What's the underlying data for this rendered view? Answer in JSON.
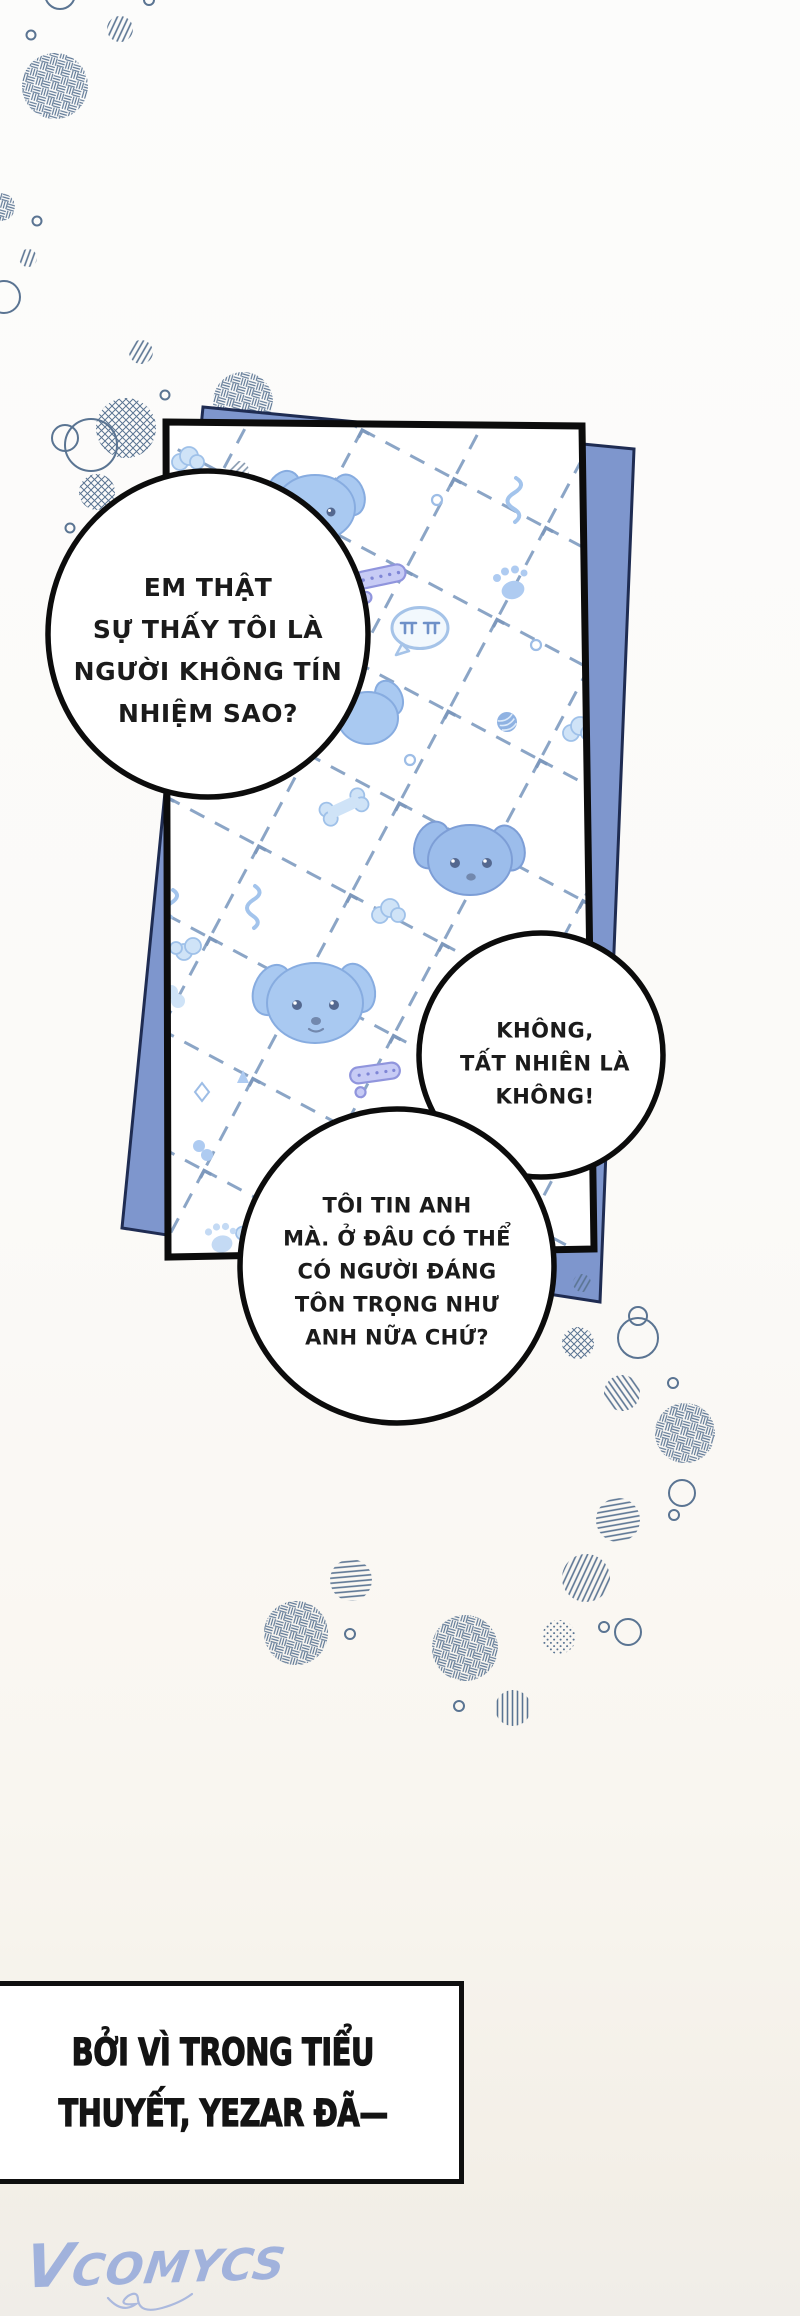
{
  "bubbles": {
    "question": {
      "lines": [
        "EM THẬT",
        "SỰ THẤY TÔI LÀ",
        "NGƯỜI KHÔNG TÍN",
        "NHIỆM SAO?"
      ]
    },
    "denial": {
      "lines": [
        "KHÔNG,",
        "TẤT NHIÊN LÀ",
        "KHÔNG!"
      ]
    },
    "trust": {
      "lines": [
        "TÔI TIN ANH",
        "MÀ. Ở ĐÂU CÓ THỂ",
        "CÓ NGƯỜI ĐÁNG",
        "TÔN TRỌNG NHƯ",
        "ANH NỮA CHỨ?"
      ]
    }
  },
  "caption": {
    "lines": [
      "BỞI VÌ TRONG TIỂU",
      "THUYẾT, YEZAR ĐÃ—"
    ]
  },
  "watermark": {
    "text": "VCOMYCS"
  },
  "colors": {
    "panel_blue": "#7e96cd",
    "panel_blue_border": "#1f2c52",
    "deco_slate": "#5a7492",
    "dash_blue": "#8ba5c6",
    "pattern_icon_blue": "#b3d0f2",
    "watermark_blue": "#8ea4da",
    "ink": "#0c0c0c"
  }
}
